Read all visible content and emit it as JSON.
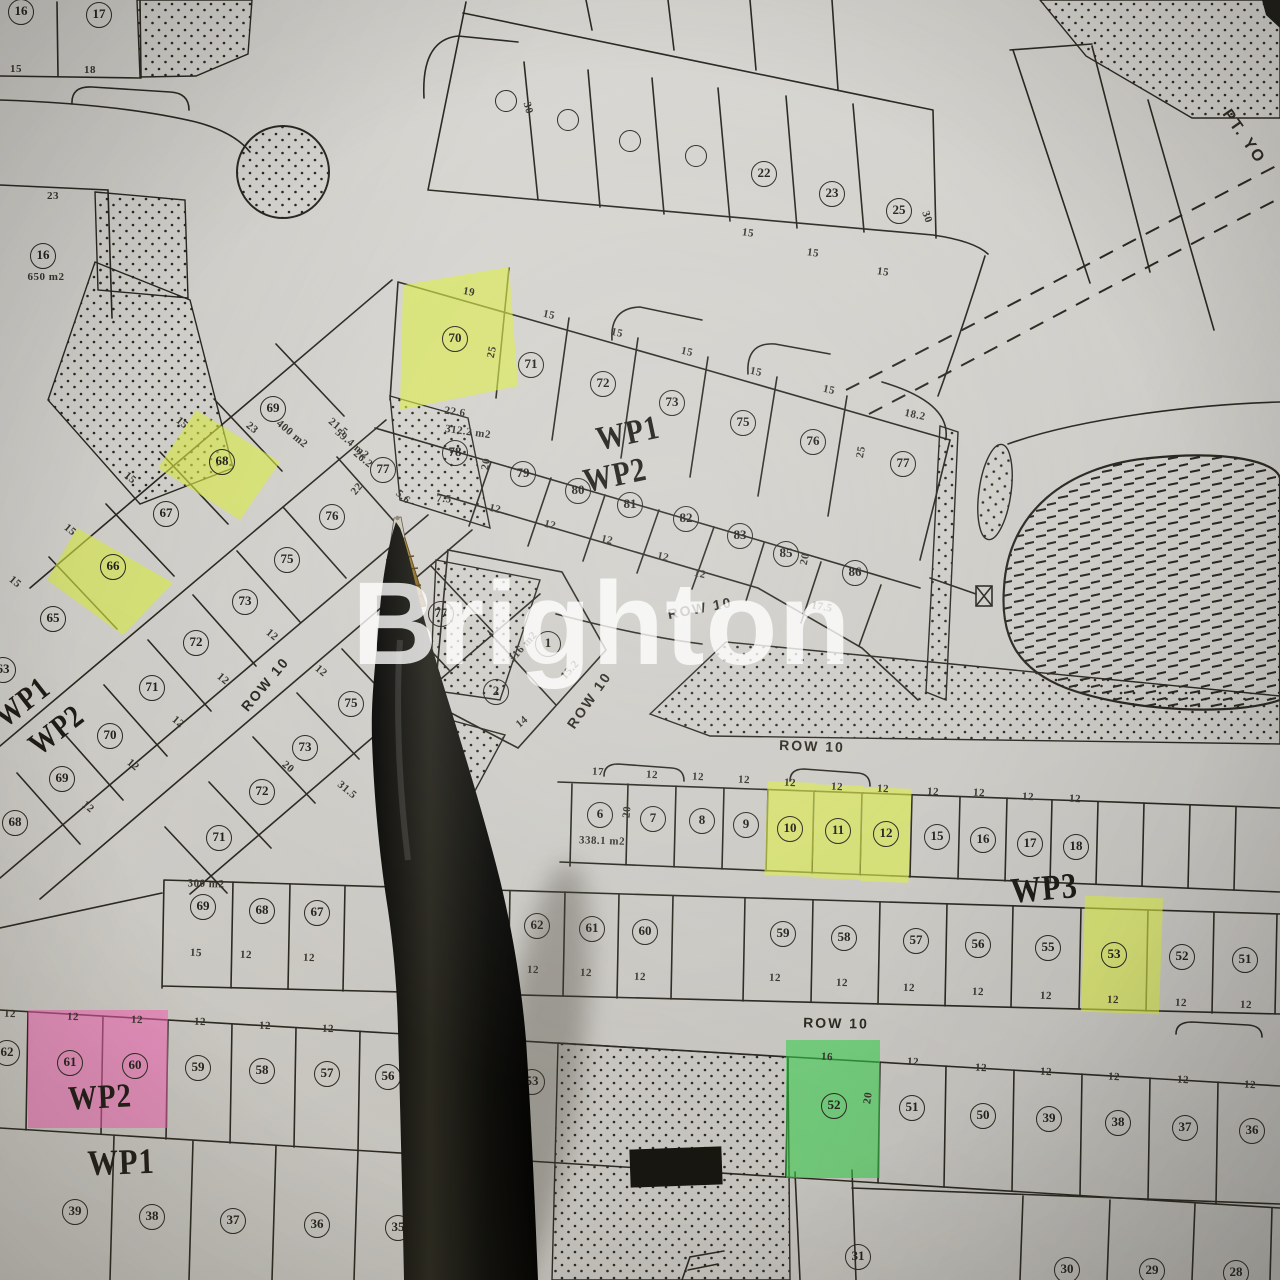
{
  "image_type": "photo of paper housing site-plan map with ballpoint pen",
  "watermark": {
    "text": "Brighton"
  },
  "corner_text": {
    "text": "PT. YO"
  },
  "colors": {
    "paper": "#d8d6d1",
    "ink": "#2a2820",
    "highlight_yellow": "#dced45",
    "highlight_pink": "#f75fb6",
    "highlight_green": "#35cc4a"
  },
  "highlighted_plots": {
    "yellow": [
      "70",
      "68",
      "66",
      "10",
      "11",
      "12",
      "53"
    ],
    "pink": [
      "61",
      "60"
    ],
    "green": [
      "52"
    ]
  },
  "zone_labels": [
    {
      "t": "WP1",
      "x": 628,
      "y": 434,
      "r": -12,
      "s": 34
    },
    {
      "t": "WP2",
      "x": 615,
      "y": 476,
      "r": -12,
      "s": 34
    },
    {
      "t": "WP1",
      "x": 22,
      "y": 702,
      "r": -38,
      "s": 32
    },
    {
      "t": "WP2",
      "x": 56,
      "y": 730,
      "r": -38,
      "s": 32
    },
    {
      "t": "WP3",
      "x": 1044,
      "y": 888,
      "r": -5,
      "s": 36
    },
    {
      "t": "WP2",
      "x": 100,
      "y": 1098,
      "r": -3,
      "s": 34
    },
    {
      "t": "WP1",
      "x": 121,
      "y": 1162,
      "r": -2,
      "s": 36
    }
  ],
  "road_labels": [
    {
      "t": "ROW 10",
      "x": 265,
      "y": 684,
      "r": -50
    },
    {
      "t": "ROW 10",
      "x": 589,
      "y": 700,
      "r": -55
    },
    {
      "t": "ROW 10",
      "x": 700,
      "y": 608,
      "r": -11
    },
    {
      "t": "ROW 10",
      "x": 812,
      "y": 746,
      "r": 2
    },
    {
      "t": "ROW 10",
      "x": 836,
      "y": 1023,
      "r": 1
    }
  ],
  "plots": [
    {
      "n": "16",
      "x": 21,
      "y": 12
    },
    {
      "n": "17",
      "x": 99,
      "y": 15
    },
    {
      "n": "",
      "x": 506,
      "y": 101,
      "e": 1
    },
    {
      "n": "",
      "x": 568,
      "y": 120,
      "e": 1
    },
    {
      "n": "",
      "x": 630,
      "y": 141,
      "e": 1
    },
    {
      "n": "",
      "x": 696,
      "y": 156,
      "e": 1
    },
    {
      "n": "22",
      "x": 764,
      "y": 174
    },
    {
      "n": "23",
      "x": 832,
      "y": 194
    },
    {
      "n": "25",
      "x": 899,
      "y": 211
    },
    {
      "n": "16",
      "x": 43,
      "y": 256
    },
    {
      "n": "70",
      "x": 455,
      "y": 339,
      "hl": "yellow"
    },
    {
      "n": "71",
      "x": 531,
      "y": 365
    },
    {
      "n": "72",
      "x": 603,
      "y": 384
    },
    {
      "n": "73",
      "x": 672,
      "y": 403
    },
    {
      "n": "75",
      "x": 743,
      "y": 423
    },
    {
      "n": "76",
      "x": 813,
      "y": 442
    },
    {
      "n": "77",
      "x": 903,
      "y": 464
    },
    {
      "n": "78",
      "x": 455,
      "y": 453
    },
    {
      "n": "79",
      "x": 523,
      "y": 474
    },
    {
      "n": "80",
      "x": 578,
      "y": 491
    },
    {
      "n": "81",
      "x": 630,
      "y": 505
    },
    {
      "n": "82",
      "x": 686,
      "y": 519
    },
    {
      "n": "83",
      "x": 740,
      "y": 536
    },
    {
      "n": "85",
      "x": 786,
      "y": 554
    },
    {
      "n": "86",
      "x": 855,
      "y": 573
    },
    {
      "n": "69",
      "x": 273,
      "y": 409
    },
    {
      "n": "68",
      "x": 222,
      "y": 462,
      "hl": "yellow"
    },
    {
      "n": "67",
      "x": 166,
      "y": 514
    },
    {
      "n": "66",
      "x": 113,
      "y": 567,
      "hl": "yellow"
    },
    {
      "n": "65",
      "x": 53,
      "y": 619
    },
    {
      "n": "63",
      "x": 3,
      "y": 670
    },
    {
      "n": "77",
      "x": 383,
      "y": 470
    },
    {
      "n": "76",
      "x": 332,
      "y": 517
    },
    {
      "n": "75",
      "x": 287,
      "y": 560
    },
    {
      "n": "73",
      "x": 245,
      "y": 602
    },
    {
      "n": "72",
      "x": 196,
      "y": 643
    },
    {
      "n": "71",
      "x": 152,
      "y": 688
    },
    {
      "n": "70",
      "x": 110,
      "y": 736
    },
    {
      "n": "69",
      "x": 62,
      "y": 779
    },
    {
      "n": "68",
      "x": 15,
      "y": 823
    },
    {
      "n": "77",
      "x": 441,
      "y": 614
    },
    {
      "n": "75",
      "x": 351,
      "y": 704
    },
    {
      "n": "73",
      "x": 305,
      "y": 748
    },
    {
      "n": "72",
      "x": 262,
      "y": 792
    },
    {
      "n": "71",
      "x": 219,
      "y": 838
    },
    {
      "n": "1",
      "x": 548,
      "y": 644
    },
    {
      "n": "2",
      "x": 496,
      "y": 692
    },
    {
      "n": "6",
      "x": 600,
      "y": 815
    },
    {
      "n": "7",
      "x": 653,
      "y": 819
    },
    {
      "n": "8",
      "x": 702,
      "y": 821
    },
    {
      "n": "9",
      "x": 746,
      "y": 825
    },
    {
      "n": "10",
      "x": 790,
      "y": 829,
      "hl": "yellow"
    },
    {
      "n": "11",
      "x": 838,
      "y": 831,
      "hl": "yellow"
    },
    {
      "n": "12",
      "x": 886,
      "y": 834,
      "hl": "yellow"
    },
    {
      "n": "15",
      "x": 937,
      "y": 837
    },
    {
      "n": "16",
      "x": 983,
      "y": 840
    },
    {
      "n": "17",
      "x": 1030,
      "y": 844
    },
    {
      "n": "18",
      "x": 1076,
      "y": 847
    },
    {
      "n": "69",
      "x": 203,
      "y": 907
    },
    {
      "n": "68",
      "x": 262,
      "y": 911
    },
    {
      "n": "67",
      "x": 317,
      "y": 913
    },
    {
      "n": "63",
      "x": 482,
      "y": 922
    },
    {
      "n": "62",
      "x": 537,
      "y": 926
    },
    {
      "n": "61",
      "x": 592,
      "y": 929
    },
    {
      "n": "60",
      "x": 645,
      "y": 932
    },
    {
      "n": "59",
      "x": 783,
      "y": 934
    },
    {
      "n": "58",
      "x": 844,
      "y": 938
    },
    {
      "n": "57",
      "x": 916,
      "y": 941
    },
    {
      "n": "56",
      "x": 978,
      "y": 945
    },
    {
      "n": "55",
      "x": 1048,
      "y": 948
    },
    {
      "n": "53",
      "x": 1114,
      "y": 955,
      "hl": "yellow"
    },
    {
      "n": "52",
      "x": 1182,
      "y": 957
    },
    {
      "n": "51",
      "x": 1245,
      "y": 960
    },
    {
      "n": "62",
      "x": 7,
      "y": 1053
    },
    {
      "n": "61",
      "x": 70,
      "y": 1063,
      "hl": "pink"
    },
    {
      "n": "60",
      "x": 135,
      "y": 1066,
      "hl": "pink"
    },
    {
      "n": "59",
      "x": 198,
      "y": 1068
    },
    {
      "n": "58",
      "x": 262,
      "y": 1071
    },
    {
      "n": "57",
      "x": 327,
      "y": 1074
    },
    {
      "n": "56",
      "x": 388,
      "y": 1077
    },
    {
      "n": "53",
      "x": 532,
      "y": 1082
    },
    {
      "n": "52",
      "x": 834,
      "y": 1106,
      "hl": "green"
    },
    {
      "n": "51",
      "x": 912,
      "y": 1108
    },
    {
      "n": "50",
      "x": 983,
      "y": 1116
    },
    {
      "n": "39",
      "x": 1049,
      "y": 1119
    },
    {
      "n": "38",
      "x": 1118,
      "y": 1123
    },
    {
      "n": "37",
      "x": 1185,
      "y": 1128
    },
    {
      "n": "36",
      "x": 1252,
      "y": 1131
    },
    {
      "n": "39",
      "x": 75,
      "y": 1212
    },
    {
      "n": "38",
      "x": 152,
      "y": 1217
    },
    {
      "n": "37",
      "x": 233,
      "y": 1221
    },
    {
      "n": "36",
      "x": 317,
      "y": 1225
    },
    {
      "n": "35",
      "x": 398,
      "y": 1228
    },
    {
      "n": "31",
      "x": 858,
      "y": 1257
    },
    {
      "n": "30",
      "x": 1067,
      "y": 1270
    },
    {
      "n": "29",
      "x": 1152,
      "y": 1271
    },
    {
      "n": "28",
      "x": 1236,
      "y": 1273
    }
  ],
  "dims": [
    {
      "t": "15",
      "x": 16,
      "y": 69
    },
    {
      "t": "18",
      "x": 90,
      "y": 70
    },
    {
      "t": "23",
      "x": 53,
      "y": 196
    },
    {
      "t": "650 m2",
      "x": 46,
      "y": 277
    },
    {
      "t": "30",
      "x": 528,
      "y": 108,
      "r": 75
    },
    {
      "t": "15",
      "x": 748,
      "y": 233,
      "r": 8
    },
    {
      "t": "15",
      "x": 813,
      "y": 253,
      "r": 8
    },
    {
      "t": "15",
      "x": 883,
      "y": 272,
      "r": 8
    },
    {
      "t": "30",
      "x": 927,
      "y": 217,
      "r": 70
    },
    {
      "t": "19",
      "x": 469,
      "y": 292,
      "r": 10
    },
    {
      "t": "25",
      "x": 492,
      "y": 352,
      "r": -78
    },
    {
      "t": "15",
      "x": 549,
      "y": 315,
      "r": 12
    },
    {
      "t": "15",
      "x": 617,
      "y": 333,
      "r": 12
    },
    {
      "t": "15",
      "x": 687,
      "y": 352,
      "r": 12
    },
    {
      "t": "15",
      "x": 756,
      "y": 372,
      "r": 12
    },
    {
      "t": "15",
      "x": 829,
      "y": 390,
      "r": 12
    },
    {
      "t": "18.2",
      "x": 915,
      "y": 415,
      "r": 12
    },
    {
      "t": "25",
      "x": 861,
      "y": 452,
      "r": -80
    },
    {
      "t": "22.6",
      "x": 455,
      "y": 412,
      "r": 8
    },
    {
      "t": "312.2 m2",
      "x": 468,
      "y": 432,
      "r": 8
    },
    {
      "t": "20",
      "x": 486,
      "y": 464,
      "r": -80
    },
    {
      "t": "7.5",
      "x": 444,
      "y": 499,
      "r": 5
    },
    {
      "t": "12",
      "x": 495,
      "y": 509,
      "r": 14
    },
    {
      "t": "12",
      "x": 550,
      "y": 525,
      "r": 14
    },
    {
      "t": "12",
      "x": 607,
      "y": 540,
      "r": 14
    },
    {
      "t": "12",
      "x": 663,
      "y": 557,
      "r": 14
    },
    {
      "t": "12",
      "x": 700,
      "y": 574,
      "r": 14
    },
    {
      "t": "20",
      "x": 805,
      "y": 559,
      "r": -78
    },
    {
      "t": "17.5",
      "x": 822,
      "y": 607,
      "r": 10
    },
    {
      "t": "15",
      "x": 182,
      "y": 423,
      "r": 40
    },
    {
      "t": "23",
      "x": 252,
      "y": 428,
      "r": 40
    },
    {
      "t": "400 m2",
      "x": 292,
      "y": 434,
      "r": 40
    },
    {
      "t": "21.5",
      "x": 338,
      "y": 427,
      "r": 40
    },
    {
      "t": "59.4 m2",
      "x": 352,
      "y": 444,
      "r": 40
    },
    {
      "t": "26.2",
      "x": 363,
      "y": 459,
      "r": 40
    },
    {
      "t": "22",
      "x": 357,
      "y": 489,
      "r": -50
    },
    {
      "t": "5.6",
      "x": 403,
      "y": 497,
      "r": 40
    },
    {
      "t": "15",
      "x": 130,
      "y": 478,
      "r": 40
    },
    {
      "t": "15",
      "x": 70,
      "y": 530,
      "r": 40
    },
    {
      "t": "15",
      "x": 15,
      "y": 582,
      "r": 40
    },
    {
      "t": "12",
      "x": 272,
      "y": 635,
      "r": 40
    },
    {
      "t": "12",
      "x": 223,
      "y": 679,
      "r": 40
    },
    {
      "t": "12",
      "x": 178,
      "y": 722,
      "r": 40
    },
    {
      "t": "12",
      "x": 321,
      "y": 671,
      "r": 40
    },
    {
      "t": "12",
      "x": 133,
      "y": 765,
      "r": 40
    },
    {
      "t": "12",
      "x": 88,
      "y": 807,
      "r": 40
    },
    {
      "t": "316 m2",
      "x": 523,
      "y": 647,
      "r": -48
    },
    {
      "t": "15.2",
      "x": 570,
      "y": 670,
      "r": -48
    },
    {
      "t": "14",
      "x": 522,
      "y": 722,
      "r": -40
    },
    {
      "t": "20",
      "x": 288,
      "y": 767,
      "r": 40
    },
    {
      "t": "31.5",
      "x": 347,
      "y": 790,
      "r": 40
    },
    {
      "t": "17",
      "x": 598,
      "y": 772,
      "r": 3
    },
    {
      "t": "12",
      "x": 652,
      "y": 775,
      "r": 3
    },
    {
      "t": "12",
      "x": 698,
      "y": 777,
      "r": 3
    },
    {
      "t": "12",
      "x": 744,
      "y": 780,
      "r": 3
    },
    {
      "t": "12",
      "x": 790,
      "y": 783,
      "r": 3
    },
    {
      "t": "12",
      "x": 837,
      "y": 787,
      "r": 3
    },
    {
      "t": "12",
      "x": 883,
      "y": 789,
      "r": 3
    },
    {
      "t": "12",
      "x": 933,
      "y": 792,
      "r": 3
    },
    {
      "t": "12",
      "x": 979,
      "y": 793,
      "r": 3
    },
    {
      "t": "12",
      "x": 1028,
      "y": 797,
      "r": 3
    },
    {
      "t": "12",
      "x": 1075,
      "y": 799,
      "r": 3
    },
    {
      "t": "20",
      "x": 627,
      "y": 812,
      "r": -85
    },
    {
      "t": "338.1 m2",
      "x": 602,
      "y": 841,
      "r": 2
    },
    {
      "t": "300 m2",
      "x": 206,
      "y": 884,
      "r": 2
    },
    {
      "t": "15",
      "x": 196,
      "y": 953,
      "r": 2
    },
    {
      "t": "12",
      "x": 246,
      "y": 955,
      "r": 2
    },
    {
      "t": "12",
      "x": 309,
      "y": 958,
      "r": 2
    },
    {
      "t": "12",
      "x": 477,
      "y": 967,
      "r": 2
    },
    {
      "t": "12",
      "x": 533,
      "y": 970,
      "r": 2
    },
    {
      "t": "12",
      "x": 586,
      "y": 973,
      "r": 2
    },
    {
      "t": "12",
      "x": 640,
      "y": 977,
      "r": 2
    },
    {
      "t": "12",
      "x": 775,
      "y": 978,
      "r": 2
    },
    {
      "t": "12",
      "x": 842,
      "y": 983,
      "r": 2
    },
    {
      "t": "12",
      "x": 909,
      "y": 988,
      "r": 2
    },
    {
      "t": "12",
      "x": 978,
      "y": 992,
      "r": 2
    },
    {
      "t": "12",
      "x": 1046,
      "y": 996,
      "r": 2
    },
    {
      "t": "12",
      "x": 1113,
      "y": 1000,
      "r": 2
    },
    {
      "t": "12",
      "x": 1181,
      "y": 1003,
      "r": 2
    },
    {
      "t": "12",
      "x": 1246,
      "y": 1005,
      "r": 2
    },
    {
      "t": "12",
      "x": 10,
      "y": 1014,
      "r": 2
    },
    {
      "t": "12",
      "x": 73,
      "y": 1017,
      "r": 2
    },
    {
      "t": "12",
      "x": 137,
      "y": 1020,
      "r": 2
    },
    {
      "t": "12",
      "x": 200,
      "y": 1022,
      "r": 2
    },
    {
      "t": "12",
      "x": 265,
      "y": 1026,
      "r": 2
    },
    {
      "t": "12",
      "x": 328,
      "y": 1029,
      "r": 2
    },
    {
      "t": "16",
      "x": 827,
      "y": 1057,
      "r": 3
    },
    {
      "t": "20",
      "x": 868,
      "y": 1098,
      "r": -82
    },
    {
      "t": "12",
      "x": 913,
      "y": 1062,
      "r": 3
    },
    {
      "t": "12",
      "x": 981,
      "y": 1068,
      "r": 3
    },
    {
      "t": "12",
      "x": 1046,
      "y": 1072,
      "r": 3
    },
    {
      "t": "12",
      "x": 1114,
      "y": 1077,
      "r": 3
    },
    {
      "t": "12",
      "x": 1183,
      "y": 1080,
      "r": 3
    },
    {
      "t": "12",
      "x": 1250,
      "y": 1085,
      "r": 3
    }
  ]
}
